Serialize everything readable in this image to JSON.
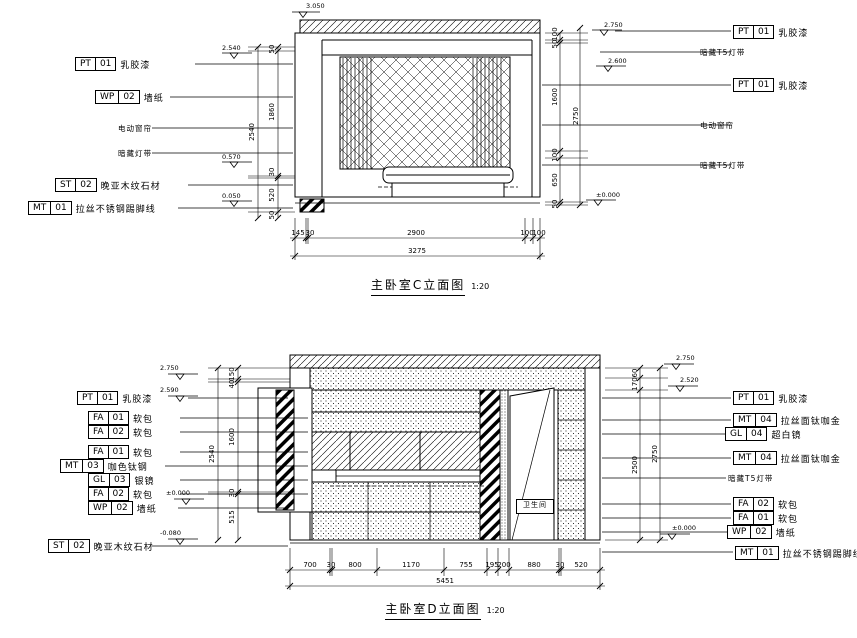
{
  "canvas": {
    "bg": "#ffffff",
    "ink": "#000000"
  },
  "top_view": {
    "title": "主卧室C立面图",
    "scale": "1:20",
    "tags_left": [
      {
        "code": "PT",
        "num": "01",
        "text": "乳胶漆"
      },
      {
        "code": "WP",
        "num": "02",
        "text": "墙纸"
      },
      {
        "code": "ST",
        "num": "02",
        "text": "晚亚木纹石材"
      },
      {
        "code": "MT",
        "num": "01",
        "text": "拉丝不锈钢踢脚线"
      }
    ],
    "notes_left": [
      "电动窗帘",
      "暗藏灯带"
    ],
    "tags_right": [
      {
        "code": "PT",
        "num": "01",
        "text": "乳胶漆"
      },
      {
        "code": "PT",
        "num": "01",
        "text": "乳胶漆"
      }
    ],
    "notes_right": [
      "暗藏T5灯带",
      "电动窗帘",
      "暗藏T5灯带"
    ],
    "dims_bottom": [
      "145",
      "30",
      "2900",
      "100",
      "100"
    ],
    "dims_bottom_total": "3275",
    "dims_left": [
      "50",
      "1860",
      "30",
      "520",
      "50"
    ],
    "dims_left_total": "2540",
    "dims_right": [
      "100",
      "50",
      "1600",
      "100",
      "650",
      "50"
    ],
    "dims_right_total": "2750",
    "marker_top": "3.050",
    "markers_left": [
      "2.540",
      "0.570",
      "0.050"
    ],
    "markers_right": [
      "2.750",
      "2.600",
      "±0.000"
    ]
  },
  "bottom_view": {
    "title": "主卧室D立面图",
    "scale": "1:20",
    "tags_left": [
      {
        "code": "PT",
        "num": "01",
        "text": "乳胶漆"
      },
      {
        "code": "FA",
        "num": "01",
        "text": "软包"
      },
      {
        "code": "FA",
        "num": "02",
        "text": "软包"
      },
      {
        "code": "FA",
        "num": "01",
        "text": "软包"
      },
      {
        "code": "MT",
        "num": "03",
        "text": "咖色钛钢"
      },
      {
        "code": "GL",
        "num": "03",
        "text": "银镜"
      },
      {
        "code": "FA",
        "num": "02",
        "text": "软包"
      },
      {
        "code": "WP",
        "num": "02",
        "text": "墙纸"
      },
      {
        "code": "ST",
        "num": "02",
        "text": "晚亚木纹石材"
      }
    ],
    "tags_right": [
      {
        "code": "PT",
        "num": "01",
        "text": "乳胶漆"
      },
      {
        "code": "MT",
        "num": "04",
        "text": "拉丝面钛咖金"
      },
      {
        "code": "GL",
        "num": "04",
        "text": "超白镜"
      },
      {
        "code": "MT",
        "num": "04",
        "text": "拉丝面钛咖金"
      },
      {
        "code": "FA",
        "num": "02",
        "text": "软包"
      },
      {
        "code": "FA",
        "num": "01",
        "text": "软包"
      },
      {
        "code": "WP",
        "num": "02",
        "text": "墙纸"
      },
      {
        "code": "MT",
        "num": "01",
        "text": "拉丝不锈钢踢脚线"
      }
    ],
    "notes_right": [
      "暗藏T5灯带"
    ],
    "door_label": "卫生间",
    "dims_bottom": [
      "700",
      "30",
      "800",
      "1170",
      "755",
      "195",
      "200",
      "880",
      "30",
      "520"
    ],
    "dims_bottom_total": "5451",
    "dims_left": [
      "150",
      "40",
      "1600",
      "30",
      "515"
    ],
    "dims_left_total": "2540",
    "dims_right": [
      "60",
      "170",
      "2500"
    ],
    "dims_right_total": "2750",
    "markers_left": [
      "2.750",
      "2.590",
      "±0.000",
      "-0.080"
    ],
    "markers_right": [
      "2.750",
      "2.520",
      "±0.000"
    ]
  }
}
